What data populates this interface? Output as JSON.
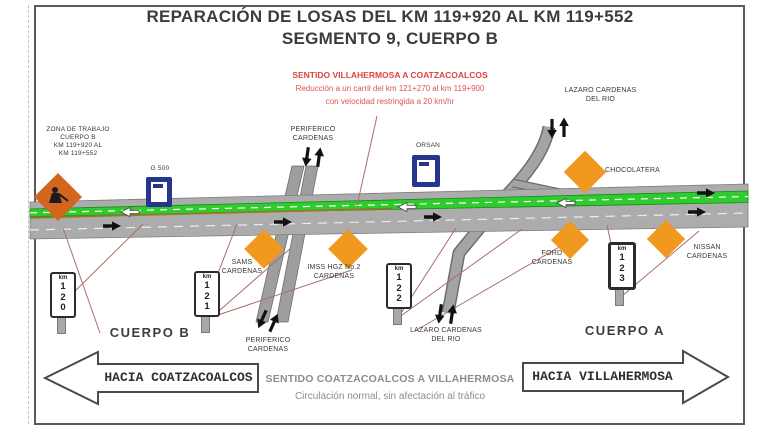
{
  "title": {
    "line1": "REPARACIÓN DE LOSAS DEL KM 119+920 AL KM 119+552",
    "line2": "SEGMENTO 9, CUERPO B"
  },
  "warning": {
    "line1": "SENTIDO VILLAHERMOSA A COATZACOALCOS",
    "line2": "Reducción a un carril del km 121+270 al km 119+900",
    "line3": "con velocidad restringida a 20 km/hr"
  },
  "work_zone": {
    "line1": "ZONA DE TRABAJO",
    "line2": "CUERPO B",
    "line3": "KM 119+920 AL",
    "line4": "KM 119+552"
  },
  "stations": {
    "g500": "G 500",
    "orsan": "ORSAN"
  },
  "streets": {
    "periferico_top": {
      "line1": "PERIFERICO",
      "line2": "CARDENAS"
    },
    "lazaro_top": {
      "line1": "LAZARO CARDENAS",
      "line2": "DEL RIO"
    },
    "lazaro_bottom": {
      "line1": "LAZARO CARDENAS",
      "line2": "DEL RIO"
    },
    "periferico_bottom": {
      "line1": "PERIFERICO",
      "line2": "CARDENAS"
    }
  },
  "pois": {
    "chocolatera": {
      "label": "CHOCOLATERA"
    },
    "sams": {
      "line1": "SAMS",
      "line2": "CARDENAS"
    },
    "imss": {
      "line1": "IMSS HGZ No.2",
      "line2": "CARDENAS"
    },
    "ford": {
      "line1": "FORD",
      "line2": "CARDENAS"
    },
    "nissan": {
      "line1": "NISSAN",
      "line2": "CARDENAS"
    }
  },
  "km_posts": {
    "p120": {
      "unit": "km",
      "d1": "1",
      "d2": "2",
      "d3": "0"
    },
    "p121": {
      "unit": "km",
      "d1": "1",
      "d2": "2",
      "d3": "1"
    },
    "p122": {
      "unit": "km",
      "d1": "1",
      "d2": "2",
      "d3": "2"
    },
    "p123": {
      "unit": "km",
      "d1": "1",
      "d2": "2",
      "d3": "3"
    }
  },
  "bodies": {
    "cuerpo_b": "CUERPO B",
    "cuerpo_a": "CUERPO A"
  },
  "direction_arrows": {
    "left": "HACIA COATZACOALCOS",
    "right": "HACIA VILLAHERMOSA"
  },
  "footer": {
    "line1": "SENTIDO COATZACOALCOS A VILLAHERMOSA",
    "line2": "Circulación normal, sin afectación al tráfico"
  },
  "colors": {
    "warning_red": "#DC4440",
    "diamond_orange": "#F0991E",
    "work_sign_orange": "#D4651F",
    "median_green": "#2FCB2F",
    "road_gray": "#ACACAC",
    "station_navy": "#27368C",
    "leader_red": "#A96F66"
  }
}
